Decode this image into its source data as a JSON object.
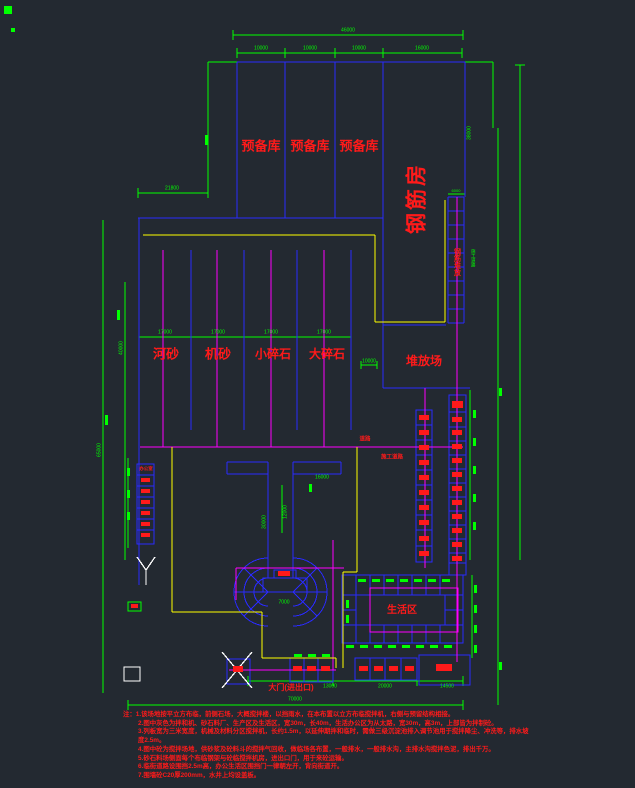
{
  "drawing_title": "施工场地平面布置图",
  "colors": {
    "background": "#232931",
    "line_green": "#00ff00",
    "line_blue": "#1a1aff",
    "line_magenta": "#ff00ff",
    "line_yellow": "#ffff00",
    "line_white": "#ffffff",
    "text_red": "#ff1a1a"
  },
  "labels": {
    "reserve": [
      "预备库",
      "预备库",
      "预备库"
    ],
    "rebar_house": "钢筋房",
    "bays": [
      "河砂",
      "机砂",
      "小碎石",
      "大碎石"
    ],
    "stack_yard": "堆放场",
    "rebar_stack": "钢筋堆放",
    "office": "办公室",
    "living_area": "生活区",
    "gate": "大门(进出口)",
    "road": "道路",
    "construction_road": "施工道路",
    "road_side": "施工道路"
  },
  "dimensions": {
    "top_total": "46000",
    "top_segments": [
      "10000",
      "10000",
      "10000",
      "16000"
    ],
    "left_top": "21800",
    "mid_segments": [
      "17000",
      "17000",
      "17000",
      "17000"
    ],
    "right_upper": "38000",
    "left_height": "65000",
    "left_mid": "40000",
    "stem_h": "16000",
    "stem_v1": "30000",
    "stem_v2": "12000",
    "pedestal": "7000",
    "yard": "10000",
    "ladder_cap": "6000",
    "bottom_segments": [
      "13000",
      "20000",
      "14500"
    ],
    "bottom_total": "70000"
  },
  "notes": {
    "prefix": "注：",
    "lines": [
      "1.该场地按平立方布临，前侧石场，大概搅拌楼，以挡雨水，在本布置以立方布临搅拌机，右侧与预留结构相接。",
      "2.图中灰色为拌和机、砂石料厂、生产区及生活区，宽30m，长40m，生活办公区为从太路，宽30m，高3m，上部皆为拌制砼。",
      "3.列板宽为三米宽度，机械及材料分区搅拌机，长约1.5m，以延伸期拌和临时，需做三级沉淀池排入调节池用于搅拌降尘、冲洗等，排水坡度2.5m。",
      "4.图中砼为搅拌场地，供砂浆及砼料斗的搅拌气回收，做临场各布置，一般排水，一般排水沟，主排水沟搅拌色泥，排出千万。",
      "5.砂石料场侧面每个布临钢架与砼临搅拌机房，进出口门，用于来砼运输。",
      "6.临街道路设围挡2.5m高，办公生活区围挡门一律朝左开，背向街道开。",
      "7.围墙砼C20厚200mm，水井上均设盖板。"
    ]
  }
}
